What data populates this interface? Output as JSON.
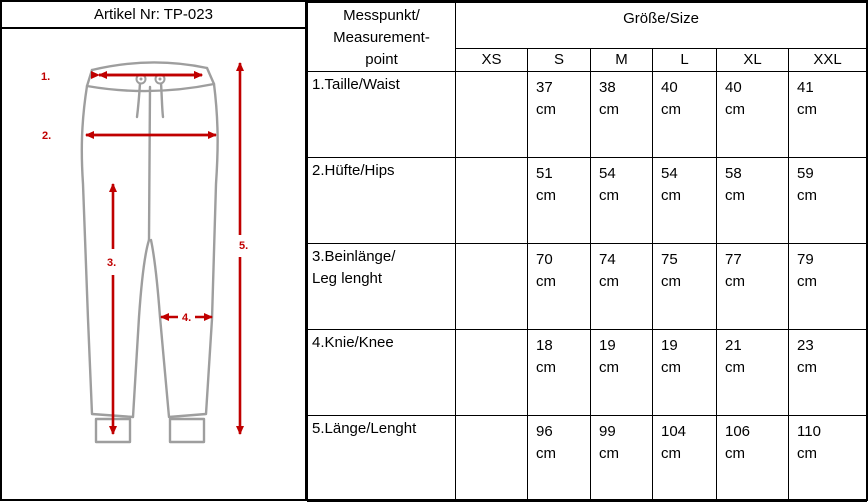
{
  "header": {
    "artikel": "Artikel Nr: TP-023"
  },
  "diagram": {
    "arrow_color": "#c00000",
    "outline_color": "#9e9e9e",
    "labels": {
      "l1": "1.",
      "l2": "2.",
      "l3": "3.",
      "l4": "4.",
      "l5": "5."
    }
  },
  "table": {
    "measurement_header": "Messpunkt/\nMeasurement-\npoint",
    "size_header": "Größe/Size",
    "sizes": [
      "XS",
      "S",
      "M",
      "L",
      "XL",
      "XXL"
    ],
    "rows": [
      {
        "label": "1.Taille/Waist",
        "cells": [
          "",
          "37\ncm",
          "38\ncm",
          "40\ncm",
          "40\ncm",
          "41\ncm"
        ]
      },
      {
        "label": "2.Hüfte/Hips",
        "cells": [
          "",
          "51\ncm",
          "54\ncm",
          "54\ncm",
          "58\ncm",
          "59\ncm"
        ]
      },
      {
        "label": "3.Beinlänge/\nLeg lenght",
        "cells": [
          "",
          "70\ncm",
          "74\ncm",
          "75\ncm",
          "77\ncm",
          "79\ncm"
        ]
      },
      {
        "label": "4.Knie/Knee",
        "cells": [
          "",
          "18\ncm",
          "19\ncm",
          "19\ncm",
          "21\ncm",
          "23\ncm"
        ]
      },
      {
        "label": "5.Länge/Lenght",
        "cells": [
          "",
          "96\ncm",
          "99\ncm",
          "104\ncm",
          "106\ncm",
          "110\ncm"
        ]
      }
    ]
  }
}
